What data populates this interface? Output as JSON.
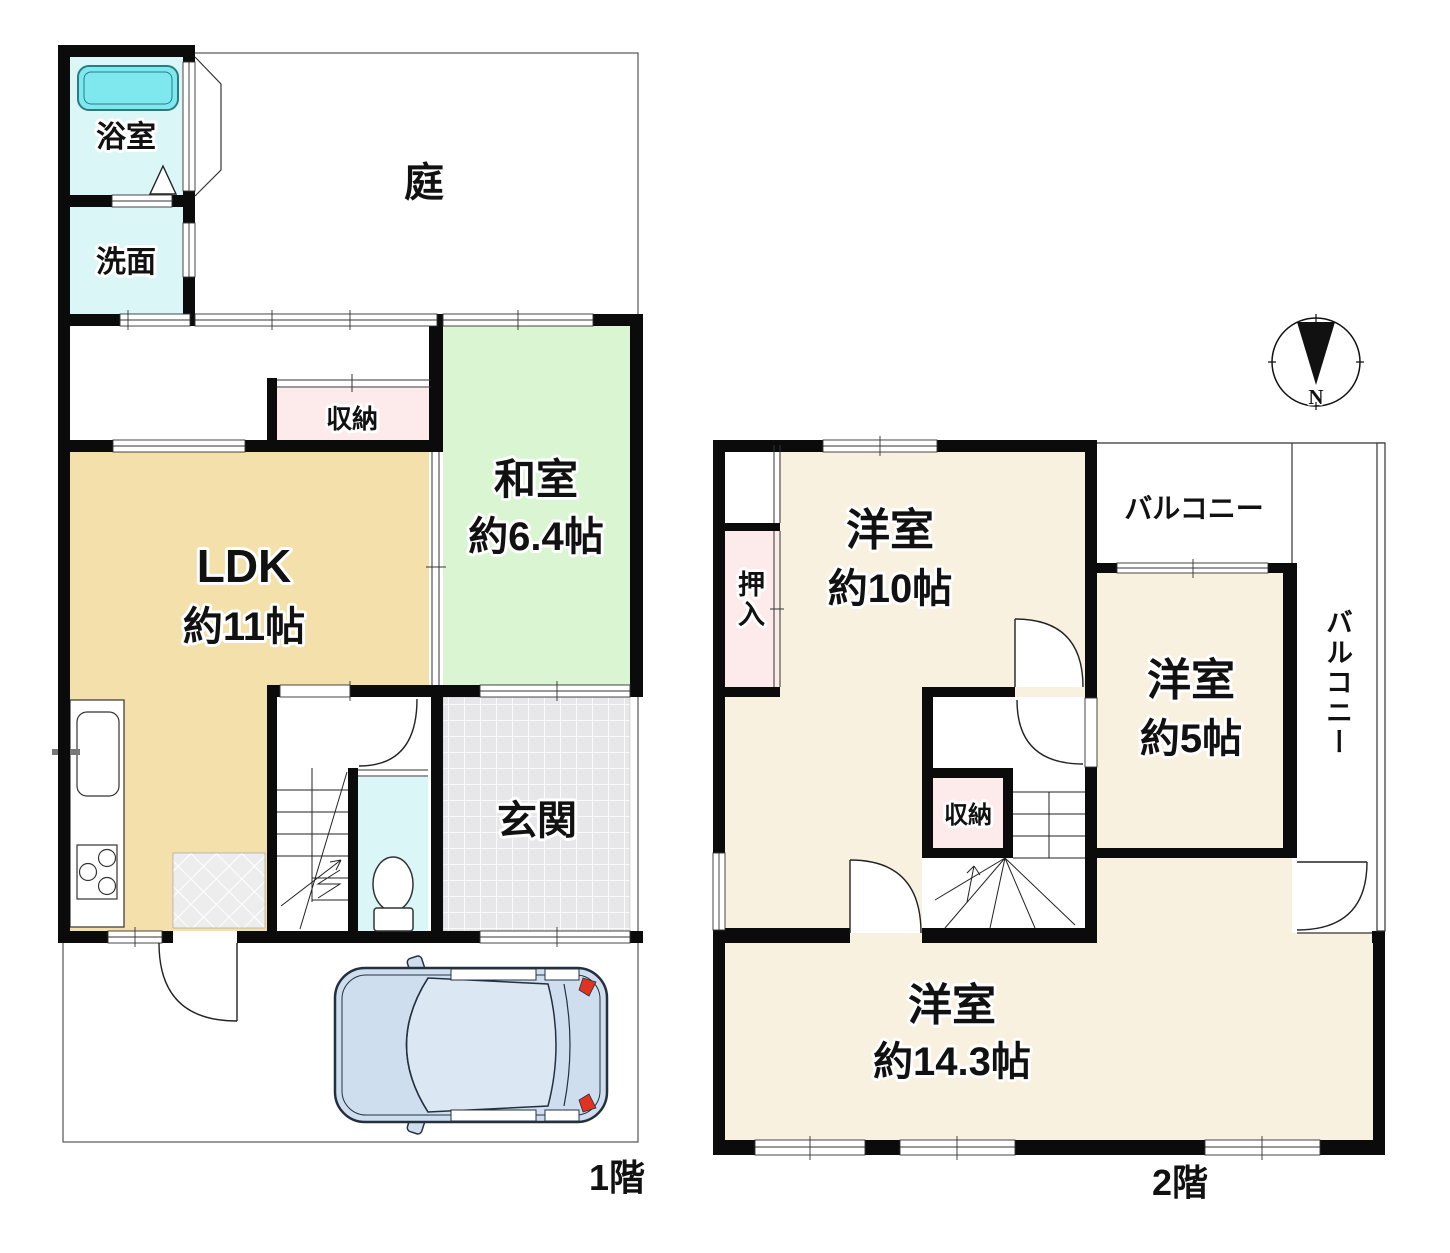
{
  "floor1": {
    "label": "1階",
    "bath": "浴室",
    "wash": "洗面",
    "garden": "庭",
    "storage": "収納",
    "ldk": "LDK",
    "ldk_size": "約11帖",
    "washitsu": "和室",
    "washitsu_size": "約6.4帖",
    "genkan": "玄関"
  },
  "floor2": {
    "label": "2階",
    "oshiire": "押入",
    "room10": "洋室",
    "room10_size": "約10帖",
    "balcony_top": "バルコニー",
    "room5": "洋室",
    "room5_size": "約5帖",
    "balcony_side": "バルコニー",
    "storage": "収納",
    "room14": "洋室",
    "room14_size": "約14.3帖"
  },
  "compass": {
    "north": "N"
  },
  "colors": {
    "wall": "#0b0b0b",
    "ldk": "#f3e0aa",
    "washitsu": "#d9f5d2",
    "cream": "#f8f1df",
    "pink": "#fcebea",
    "cyan": "#dbf6f7",
    "bathtub": "#7fe8ef",
    "genkan_tile": "#e7e7ea",
    "mat": "#ededed",
    "car_body": "#cfdeef",
    "car_glass": "#dce7f4",
    "tail_light": "#e03422"
  }
}
